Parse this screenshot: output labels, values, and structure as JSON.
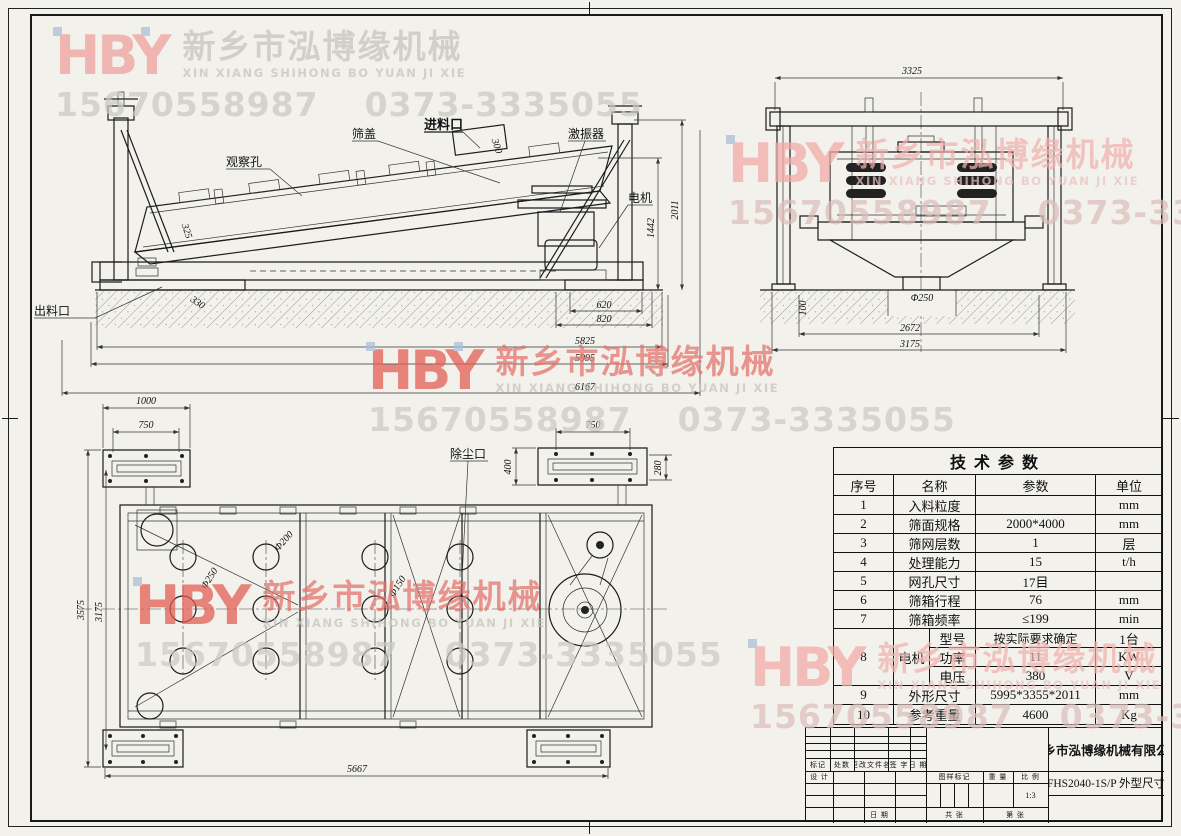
{
  "watermark": {
    "logo": "HBY",
    "company_cn": "新乡市泓博缘机械",
    "pinyin": "XIN XIANG SHIHONG BO YUAN JI XIE",
    "phone1": "15670558987",
    "phone2": "0373-3335055"
  },
  "side": {
    "labels": {
      "observation_hole": "观察孔",
      "screen_cover": "筛盖",
      "feed_inlet": "进料口",
      "exciter": "激振器",
      "motor": "电机",
      "discharge_outlet": "出料口"
    },
    "dims": {
      "feed_width": "300",
      "body_side": "325",
      "base_offset": "330",
      "foot_inner": "620",
      "foot_outer": "820",
      "length_inner": "5825",
      "length_mid": "5995",
      "length_total": "6167",
      "motor_height": "1442",
      "total_height": "2011"
    }
  },
  "end": {
    "dims": {
      "top_width": "3325",
      "outlet_dia": "Φ250",
      "pit_depth": "100",
      "leg_span": "2672",
      "base_width": "3175"
    }
  },
  "top": {
    "labels": {
      "dust_port": "除尘口"
    },
    "dims": {
      "plate_len": "1000",
      "plate_bolt": "750",
      "right_plate_bolt": "750",
      "right_plate_w": "400",
      "right_plate_h": "280",
      "width_total": "3575",
      "width_inner": "3175",
      "length": "5667",
      "hole_250": "Φ250",
      "hole_200": "Φ200",
      "hole_150": "Φ150"
    }
  },
  "table": {
    "title": "技术参数",
    "headers": {
      "no": "序号",
      "name": "名称",
      "value": "参数",
      "unit": "单位"
    },
    "rows": [
      {
        "no": "1",
        "name": "入料粒度",
        "value": "",
        "unit": "mm"
      },
      {
        "no": "2",
        "name": "筛面规格",
        "value": "2000*4000",
        "unit": "mm"
      },
      {
        "no": "3",
        "name": "筛网层数",
        "value": "1",
        "unit": "层"
      },
      {
        "no": "4",
        "name": "处理能力",
        "value": "15",
        "unit": "t/h"
      },
      {
        "no": "5",
        "name": "网孔尺寸",
        "value": "17目",
        "unit": ""
      },
      {
        "no": "6",
        "name": "筛箱行程",
        "value": "76",
        "unit": "mm"
      },
      {
        "no": "7",
        "name": "筛箱频率",
        "value": "≤199",
        "unit": "min"
      }
    ],
    "motor": {
      "no": "8",
      "name": "电机",
      "subrows": [
        {
          "name": "型号",
          "value": "按实际要求确定",
          "unit": "1台"
        },
        {
          "name": "功率",
          "value": "11",
          "unit": "KW"
        },
        {
          "name": "电压",
          "value": "380",
          "unit": "V"
        }
      ]
    },
    "rows2": [
      {
        "no": "9",
        "name": "外形尺寸",
        "value": "5995*3355*2011",
        "unit": "mm"
      },
      {
        "no": "10",
        "name": "参考重量",
        "value": "4600",
        "unit": "Kg"
      }
    ]
  },
  "title_block": {
    "rev": {
      "mark": "标记",
      "count": "处数",
      "file": "更改文件名",
      "sign": "签 字",
      "date": "日 期"
    },
    "design": "设 计",
    "date2": "日 期",
    "mark_label": "图样标记",
    "weight_label": "重 量",
    "scale_label": "比 例",
    "scale_value": "1:3",
    "sheets": "共  张",
    "sheet_no": "第  张",
    "company": "新乡市泓博缘机械有限公司",
    "drawing_no": "FHS2040-1S/P  外型尺寸"
  },
  "colors": {
    "watermark_red": "#e25b52",
    "watermark_pink": "#f2aaa6",
    "watermark_gray": "#c4c4bb",
    "line": "#1c1c1c",
    "paper": "#f2f1ec"
  }
}
